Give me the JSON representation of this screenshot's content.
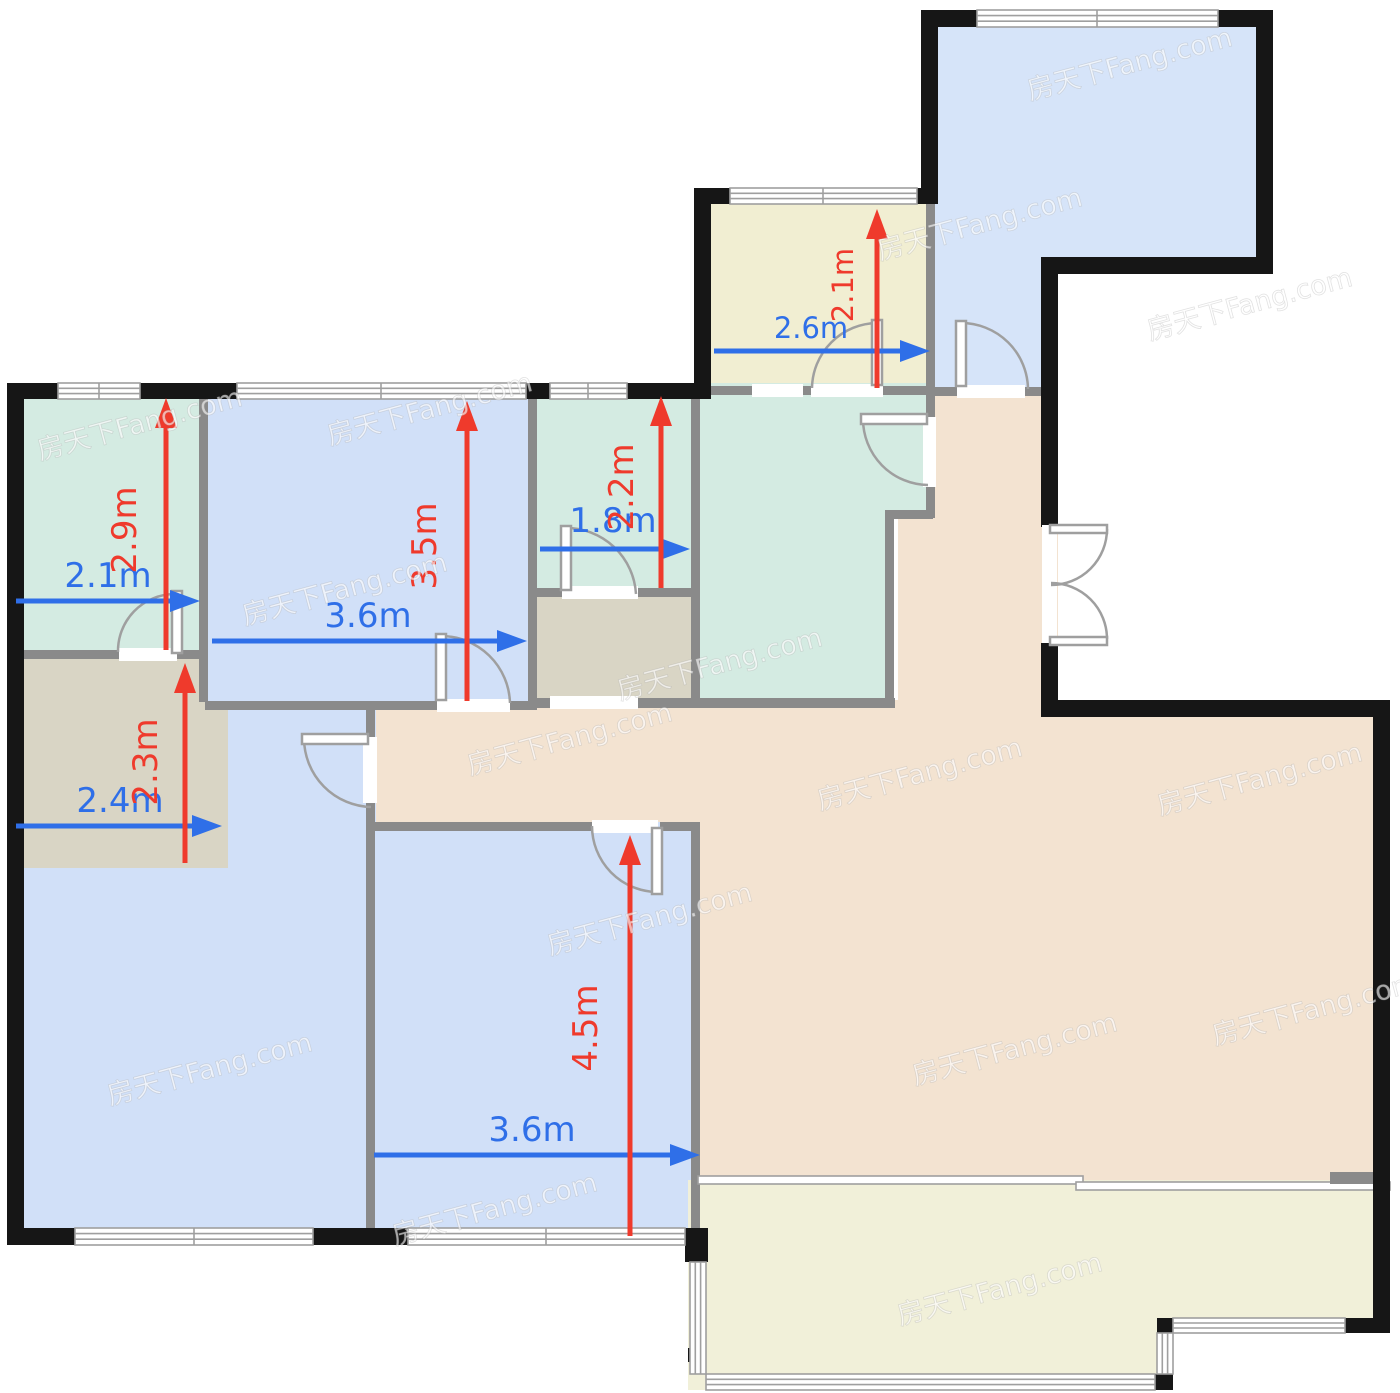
{
  "canvas": {
    "width": 1400,
    "height": 1393
  },
  "watermark": {
    "text": "房天下Fang.com"
  },
  "colors": {
    "page_bg": "#ffffff",
    "wall_black": "#161616",
    "wall_gray": "#8a8a8a",
    "window_frame": "#9f9f9f",
    "door_gray": "#9f9f9f",
    "arrow_blue": "#2f6fe8",
    "arrow_red": "#ef3a2c",
    "bedroom_blue_top_right": "#d6e4f9",
    "bedroom_blue": "#d1e0f8",
    "green_room": "#d4ebe2",
    "tan_room": "#d9d5c5",
    "living_beige": "#f3e3d1",
    "balcony_cream_top": "#f1eed2",
    "balcony_cream_bottom": "#f1f0d9"
  },
  "dims": {
    "green_tl_w": {
      "label": "2.1m"
    },
    "green_tl_h": {
      "label": "2.9m"
    },
    "room_tl_w": {
      "label": "3.6m"
    },
    "room_tl_h": {
      "label": "3.5m"
    },
    "bath_w": {
      "label": "1.8m"
    },
    "bath_h": {
      "label": "2.2m"
    },
    "balcony_top_w": {
      "label": "2.6m"
    },
    "balcony_top_h": {
      "label": "2.1m"
    },
    "alcove_w": {
      "label": "2.4m"
    },
    "alcove_h": {
      "label": "2.3m"
    },
    "room_bm_w": {
      "label": "3.6m"
    },
    "room_bm_h": {
      "label": "4.5m"
    }
  }
}
